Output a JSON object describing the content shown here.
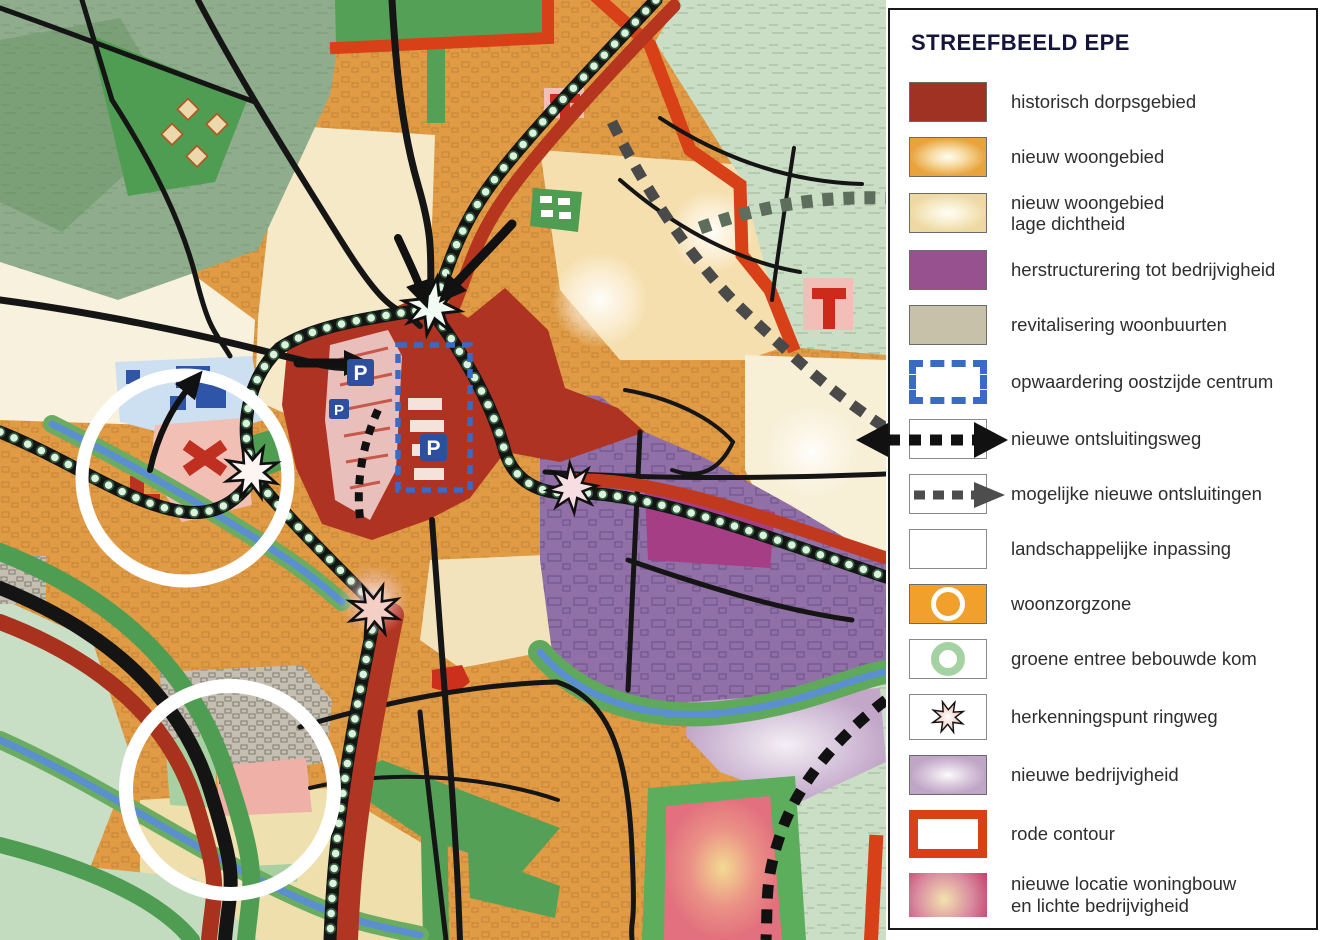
{
  "legend": {
    "title": "STREEFBEELD EPE",
    "items": [
      {
        "id": "historisch-dorpsgebied",
        "label": "historisch dorpsgebied",
        "color": "#A03223"
      },
      {
        "id": "nieuw-woongebied",
        "label": "nieuw woongebied",
        "color": "#E8A33C"
      },
      {
        "id": "nieuw-woongebied-lage-dichtheid",
        "label": "nieuw woongebied\nlage dichtheid",
        "color": "#EFD9A2"
      },
      {
        "id": "herstructurering-tot-bedrijvigheid",
        "label": "herstructurering tot bedrijvigheid",
        "color": "#97518F"
      },
      {
        "id": "revitalisering-woonbuurten",
        "label": "revitalisering woonbuurten",
        "color": "#C8C1A9"
      },
      {
        "id": "opwaardering-oostzijde-centrum",
        "label": "opwaardering oostzijde centrum",
        "color": "#3A6BC4"
      },
      {
        "id": "nieuwe-ontsluitingsweg",
        "label": "nieuwe ontsluitingsweg",
        "color": "#111111"
      },
      {
        "id": "mogelijke-nieuwe-ontsluitingen",
        "label": "mogelijke nieuwe ontsluitingen",
        "color": "#4D4D4D"
      },
      {
        "id": "landschappelijke-inpassing",
        "label": "landschappelijke inpassing",
        "color": "#4E9D50"
      },
      {
        "id": "woonzorgzone",
        "label": "woonzorgzone",
        "color": "#F0A02B"
      },
      {
        "id": "groene-entree-bebouwde-kom",
        "label": "groene entree bebouwde kom",
        "color": "#A5D2A2"
      },
      {
        "id": "herkenningspunt-ringweg",
        "label": "herkenningspunt ringweg",
        "color": "#E9B8AC"
      },
      {
        "id": "nieuwe-bedrijvigheid",
        "label": "nieuwe bedrijvigheid",
        "color": "#BFA5C6"
      },
      {
        "id": "rode-contour",
        "label": "rode contour",
        "color": "#D84018"
      },
      {
        "id": "nieuwe-locatie-woningbouw",
        "label": "nieuwe locatie woningbouw\nen lichte bedrijvigheid",
        "color": "#C23F6B"
      }
    ]
  },
  "map": {
    "markers": {
      "parking_label": "P"
    },
    "colors": {
      "residential_orange": "#E09B44",
      "historic_red": "#AF3322",
      "business_purple": "#9170A8",
      "dark_magenta": "#A63E85",
      "rural_sage": "#C6DDC2",
      "forest_green": "#85A883",
      "park_green": "#4F9D52",
      "stream_blue": "#5B8FD0",
      "ring_bead": "#DCF2DE",
      "red_contour": "#D84018",
      "cream": "#F3E6C2"
    }
  }
}
